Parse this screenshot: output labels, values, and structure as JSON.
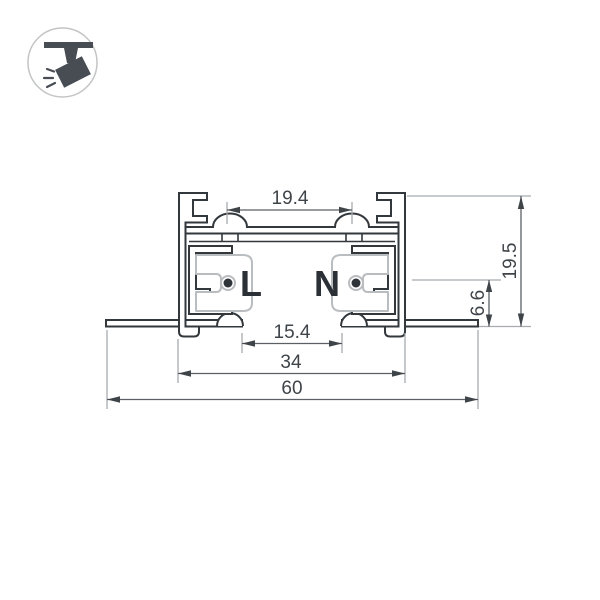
{
  "icon": {
    "name": "track-spotlight-icon",
    "meaning": "ceiling track spotlight pictogram"
  },
  "drawing": {
    "type": "technical-cross-section-diagram",
    "subject": "recessed track busbar profile",
    "conductors": {
      "live": "L",
      "neutral": "N"
    },
    "dimensions": {
      "top_inner_width": "19.4",
      "total_height": "19.5",
      "recess_depth": "6.6",
      "opening_width": "15.4",
      "body_width": "34",
      "total_width": "60"
    },
    "colors": {
      "background": "#ffffff",
      "profile_outline": "#33383d",
      "insulator_line": "#b9bdc0",
      "dimension_line": "#5c6065",
      "extension_line": "#a8acb0",
      "text": "#3f4449",
      "icon_fill": "#474d53",
      "icon_ring": "#c2c4c6"
    }
  }
}
